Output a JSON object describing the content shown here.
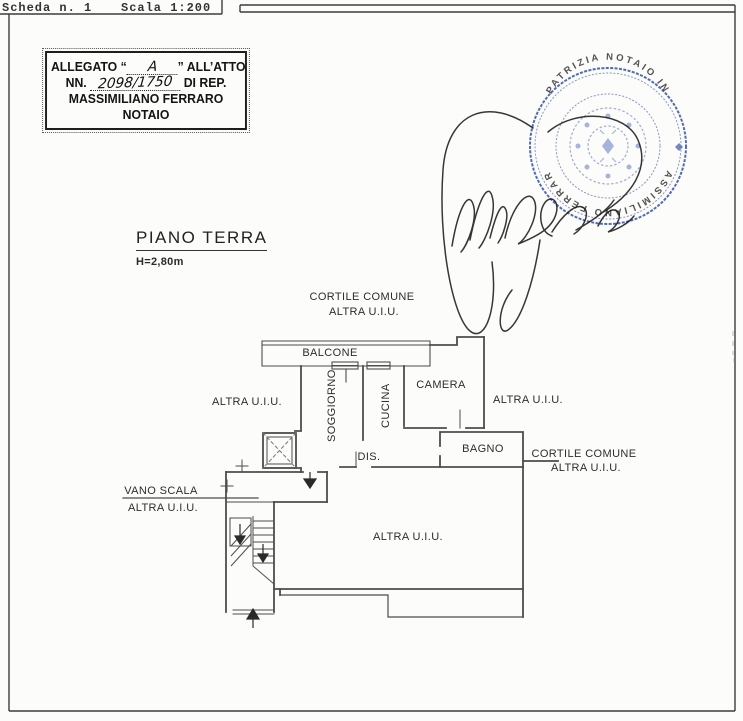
{
  "header": {
    "sheet": "Scheda n. 1",
    "scale": "Scala 1:200"
  },
  "allegato": {
    "line1_prefix": "ALLEGATO “",
    "line1_letter": "A",
    "line1_suffix": "” ALL’ATTO",
    "line2_prefix": "NN.",
    "line2_number": "2098/1750",
    "line2_suffix": "DI REP.",
    "line3": "MASSIMILIANO FERRARO",
    "line4": "NOTAIO"
  },
  "title": {
    "text": "PIANO TERRA",
    "height": "H=2,80m"
  },
  "seal": {
    "arc_top": "PATRIZIA NOTAIO IN",
    "arc_bottom": "MASSIMILIANO FERRARO",
    "color": "#2d4cab"
  },
  "labels": {
    "cortile_top_1": "CORTILE COMUNE",
    "cortile_top_2": "ALTRA U.I.U.",
    "balcone": "BALCONE",
    "soggiorno": "SOGGIORNO",
    "cucina": "CUCINA",
    "camera": "CAMERA",
    "altra_left": "ALTRA U.I.U.",
    "altra_right": "ALTRA U.I.U.",
    "bagno": "BAGNO",
    "cortile_right_1": "CORTILE COMUNE",
    "cortile_right_2": "ALTRA U.I.U.",
    "dis": "DIS.",
    "vano_scala": "VANO SCALA",
    "vano_scala_sub": "ALTRA U.I.U.",
    "altra_bottom": "ALTRA U.I.U."
  }
}
